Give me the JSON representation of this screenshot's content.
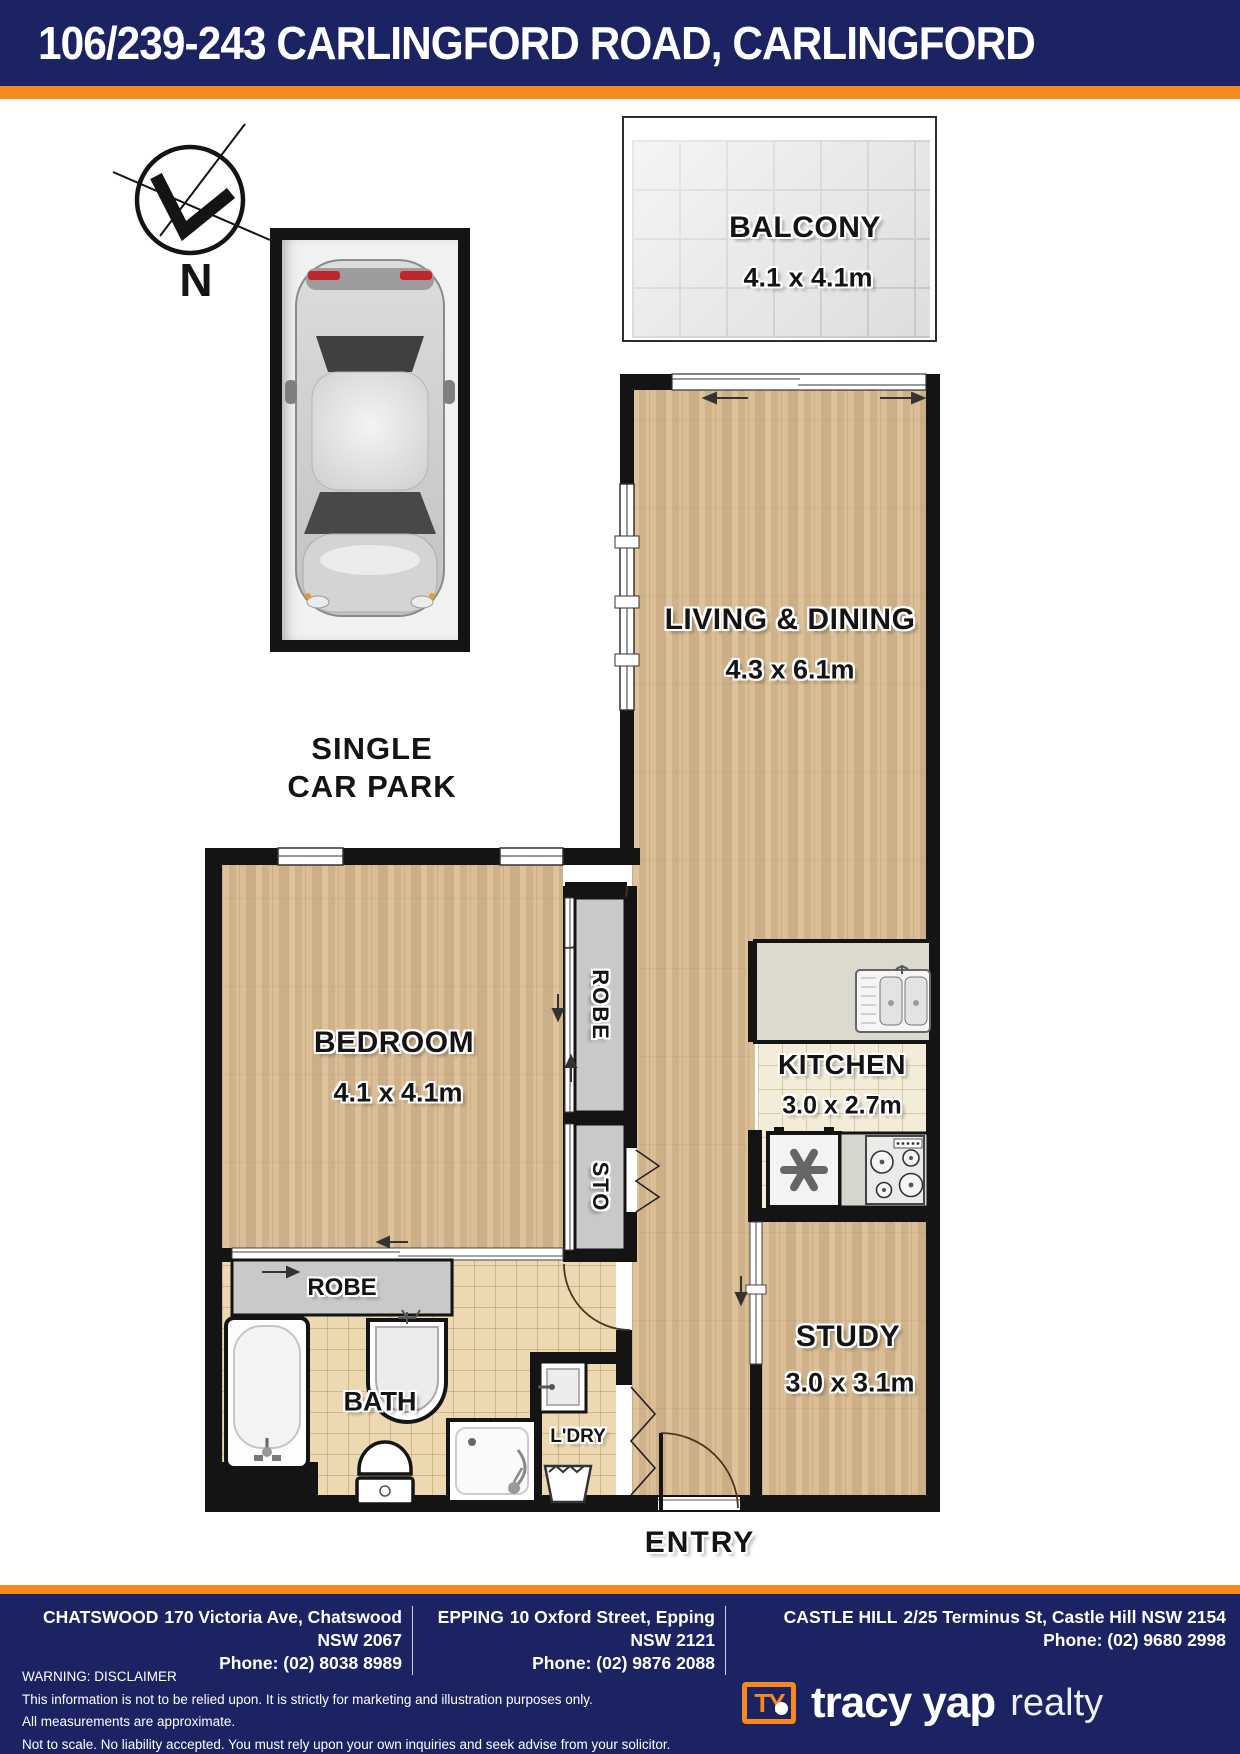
{
  "header": {
    "title": "106/239-243 CARLINGFORD ROAD, CARLINGFORD"
  },
  "compass": {
    "label": "N"
  },
  "carpark": {
    "line1": "SINGLE",
    "line2": "CAR PARK"
  },
  "rooms": {
    "balcony": {
      "name": "BALCONY",
      "dims": "4.1 x 4.1m"
    },
    "living": {
      "name": "LIVING & DINING",
      "dims": "4.3 x 6.1m"
    },
    "bedroom": {
      "name": "BEDROOM",
      "dims": "4.1 x 4.1m"
    },
    "kitchen": {
      "name": "KITCHEN",
      "dims": "3.0 x 2.7m"
    },
    "study": {
      "name": "STUDY",
      "dims": "3.0 x 3.1m"
    },
    "bath": {
      "name": "BATH"
    },
    "laundry": {
      "name": "L'DRY"
    },
    "entry": {
      "name": "ENTRY"
    },
    "robe_tall": {
      "name": "ROBE"
    },
    "storage": {
      "name": "STO"
    },
    "robe_bedroom": {
      "name": "ROBE"
    }
  },
  "footer": {
    "offices": [
      {
        "name": "CHATSWOOD",
        "address": "170 Victoria Ave, Chatswood NSW 2067",
        "phone": "Phone: (02) 8038 8989"
      },
      {
        "name": "EPPING",
        "address": "10 Oxford Street, Epping NSW 2121",
        "phone": "Phone: (02) 9876 2088"
      },
      {
        "name": "CASTLE HILL",
        "address": "2/25 Terminus St, Castle Hill NSW 2154",
        "phone": "Phone: (02) 9680 2998"
      }
    ],
    "disclaimer": [
      "WARNING: DISCLAIMER",
      "This information is not to be relied upon. It is strictly for marketing and illustration purposes only.",
      "All measurements are approximate.",
      "Not to scale. No liability accepted. You must rely upon your own inquiries and seek advise from your solicitor."
    ],
    "logo": {
      "mark": "TY",
      "name": "tracy yap",
      "suffix": "realty"
    }
  },
  "colors": {
    "navy": "#1b2362",
    "orange": "#f6891e",
    "wall": "#141414",
    "wood": "#d7b88e"
  }
}
